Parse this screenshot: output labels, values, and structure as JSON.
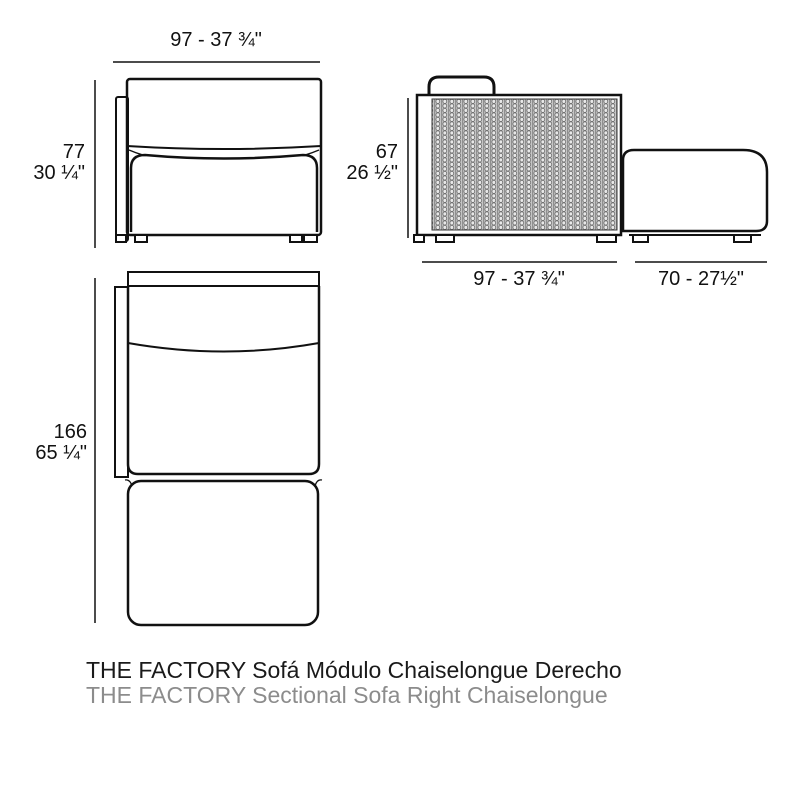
{
  "title": {
    "line1": "THE FACTORY Sofá Módulo Chaiselongue Derecho",
    "line2": "THE FACTORY Sectional Sofa Right Chaiselongue"
  },
  "front_view": {
    "width_label": "97 - 37 ¾\"",
    "height_cm": "77",
    "height_in": "30 ¼\""
  },
  "side_view": {
    "height_cm": "67",
    "height_in": "26 ½\"",
    "module_width_label": "97 - 37 ¾\"",
    "chaise_width_label": "70 - 27½\""
  },
  "top_view": {
    "depth_cm": "166",
    "depth_in": "65 ¼\""
  },
  "colors": {
    "line": "#111111",
    "title_primary": "#1a1a1a",
    "title_secondary": "#8c8c8c",
    "texture_base": "#c6c6c6"
  }
}
